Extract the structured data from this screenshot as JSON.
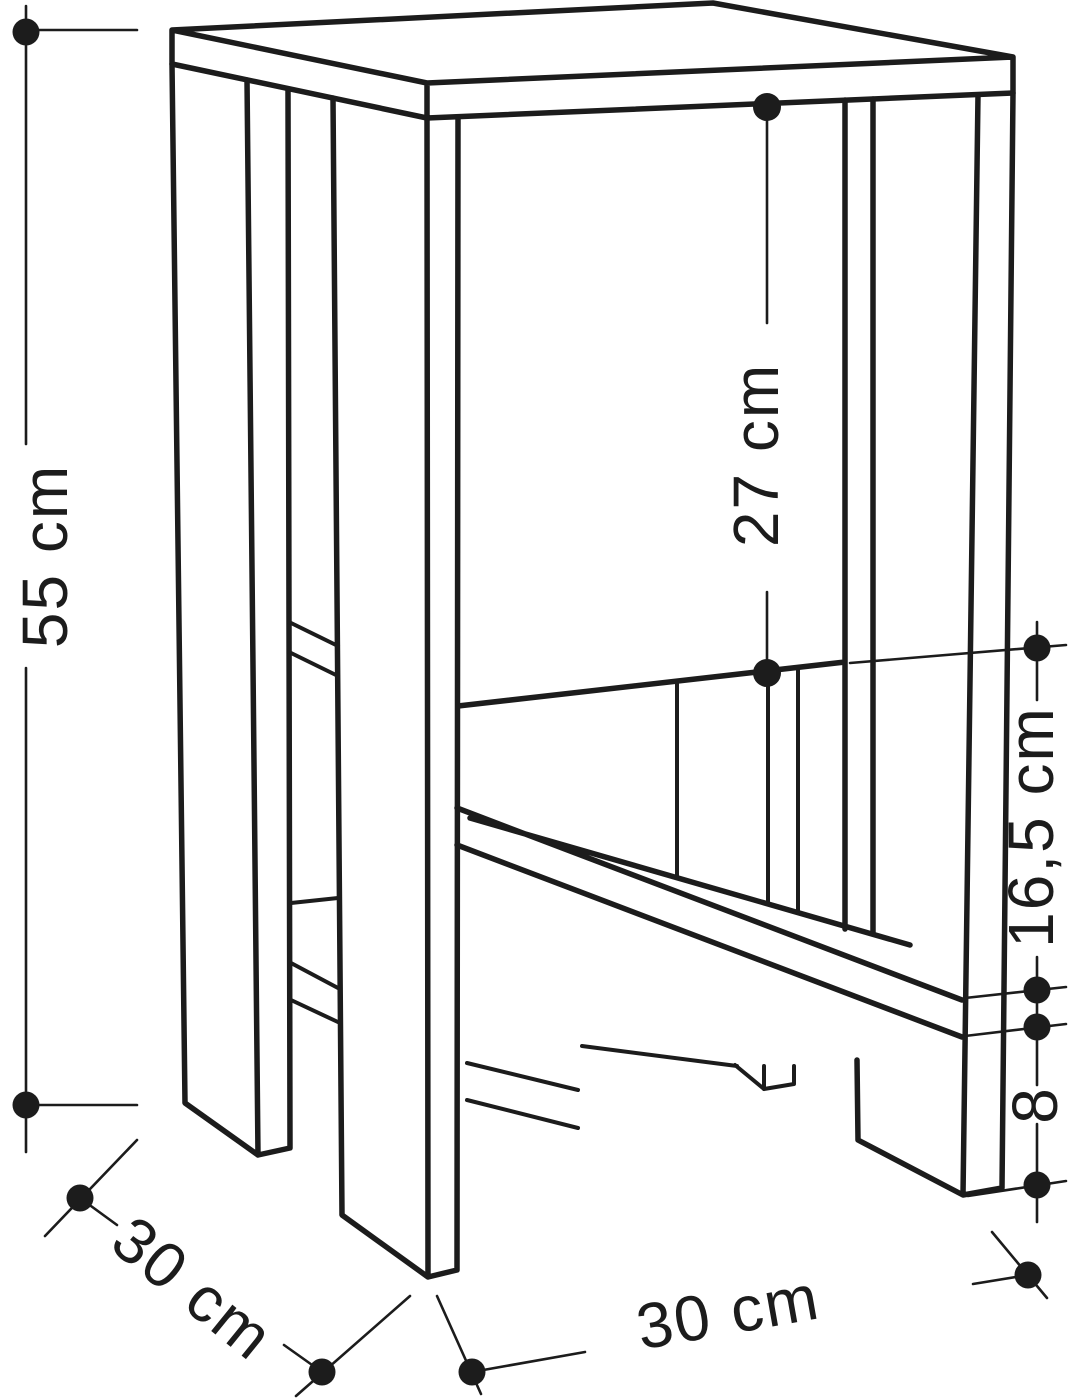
{
  "figure": {
    "kind": "furniture-dimension-drawing",
    "background_color": "#ffffff",
    "line_color": "#1c1c1c"
  },
  "dimensions": {
    "height": "55 cm",
    "upper_compartment_height": "27 cm",
    "shelf_opening_height": "16,5 cm",
    "bottom_clearance": "8",
    "depth": "30 cm",
    "width": "30 cm"
  }
}
